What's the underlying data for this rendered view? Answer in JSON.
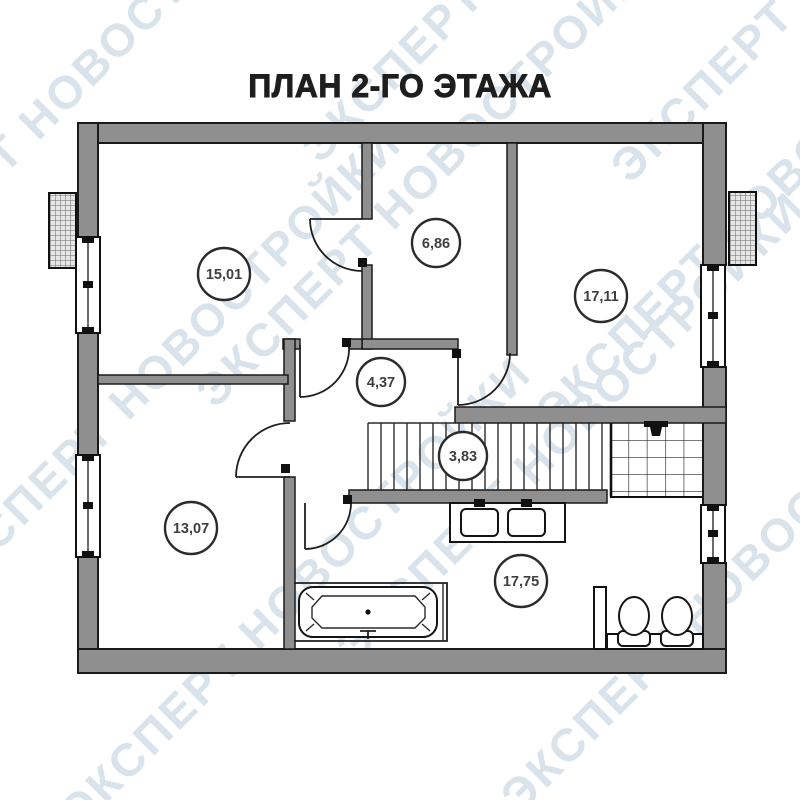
{
  "page": {
    "title": "ПЛАН 2-ГО ЭТАЖА"
  },
  "watermark": {
    "text": "ЭКСПЕРТ НОВОСТРОЙКИ"
  },
  "plan": {
    "rooms": [
      {
        "id": "room-top-left",
        "area_label": "15,01"
      },
      {
        "id": "room-top-middle",
        "area_label": "6,86"
      },
      {
        "id": "room-top-right",
        "area_label": "17,11"
      },
      {
        "id": "hallway",
        "area_label": "4,37"
      },
      {
        "id": "staircase",
        "area_label": "3,83"
      },
      {
        "id": "room-bottom-left",
        "area_label": "13,07"
      },
      {
        "id": "bathroom",
        "area_label": "17,75"
      }
    ],
    "fixtures": [
      "bathtub",
      "double-washbasin",
      "toilet",
      "toilet",
      "stairs",
      "tiled-cabin"
    ],
    "colors": {
      "wall": "#8f8f8f",
      "outline": "#1a1a1a",
      "watermark": "#d9e3eb",
      "label_text": "#3f3f3f"
    }
  }
}
